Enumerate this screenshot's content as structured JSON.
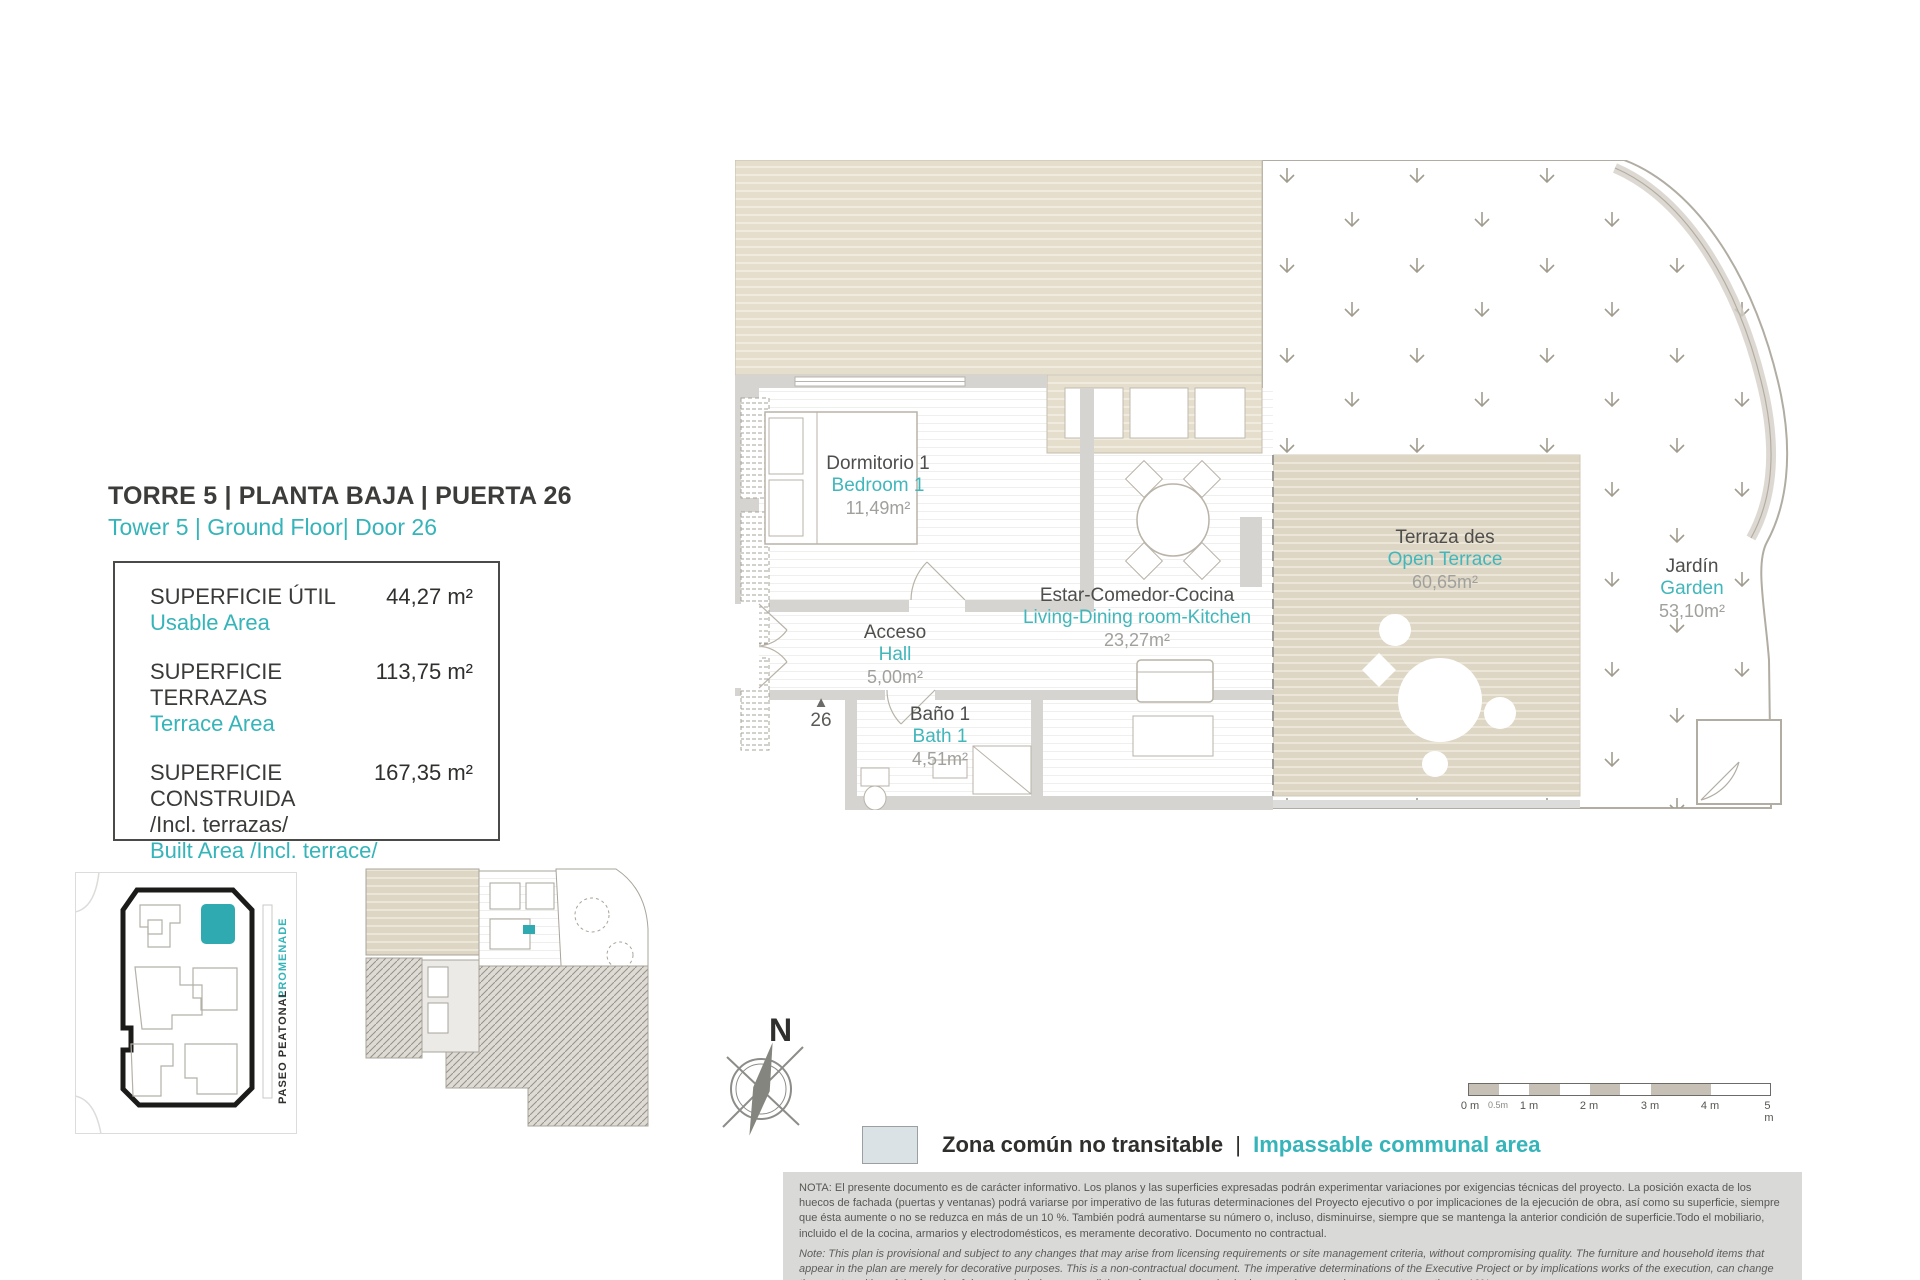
{
  "colors": {
    "accent": "#35b4b9",
    "dark_text": "#3a3a38",
    "beige_deck": "#ded6c4",
    "wall_gray": "#d5d4d0",
    "legend_swatch": "#dbe2e6",
    "note_bg": "#d9d9d8"
  },
  "header": {
    "title": "TORRE 5 | PLANTA BAJA | PUERTA 26",
    "subtitle": "Tower 5 | Ground Floor| Door 26"
  },
  "areas": {
    "rows": [
      {
        "label": "SUPERFICIE ÚTIL",
        "sublabel": "",
        "label_en": "Usable Area",
        "value": "44,27 m²"
      },
      {
        "label": "SUPERFICIE TERRAZAS",
        "sublabel": "",
        "label_en": "Terrace Area",
        "value": "113,75 m²"
      },
      {
        "label": "SUPERFICIE CONSTRUIDA",
        "sublabel": "/Incl. terrazas/",
        "label_en": "Built Area /Incl. terrace/",
        "value": "167,35 m²"
      }
    ]
  },
  "site_plan": {
    "promenade": "PROMENADE",
    "paseo": "PASEO PEATONAL"
  },
  "compass": {
    "north": "N"
  },
  "plan": {
    "entrance_marker": "▲",
    "entrance_number": "26",
    "rooms": {
      "bedroom": {
        "es": "Dormitorio 1",
        "en": "Bedroom 1",
        "area": "11,49m²"
      },
      "living": {
        "es": "Estar-Comedor-Cocina",
        "en": "Living-Dining room-Kitchen",
        "area": "23,27m²"
      },
      "hall": {
        "es": "Acceso",
        "en": "Hall",
        "area": "5,00m²"
      },
      "bath": {
        "es": "Baño 1",
        "en": "Bath 1",
        "area": "4,51m²"
      },
      "terrace": {
        "es": "Terraza des",
        "en": "Open Terrace",
        "area": "60,65m²"
      },
      "garden": {
        "es": "Jardín",
        "en": "Garden",
        "area": "53,10m²"
      }
    }
  },
  "legend": {
    "es": "Zona común no transitable",
    "sep": "|",
    "en": "Impassable communal area"
  },
  "scale_bar": {
    "labels": [
      "0 m",
      "0.5m",
      "1 m",
      "2 m",
      "3 m",
      "4 m",
      "5 m"
    ]
  },
  "notes": {
    "es": "NOTA:  El presente documento es de carácter informativo. Los planos y las superficies expresadas podrán experimentar variaciones por exigencias técnicas del proyecto. La posición exacta de los huecos de fachada (puertas y ventanas) podrá variarse por imperativo de las futuras determinaciones del Proyecto ejecutivo o por implicaciones de la ejecución de obra, así como su superficie, siempre que ésta aumente o no se reduzca en más de un 10 %. También podrá aumentarse su número o, incluso, disminuirse, siempre que se mantenga la anterior condición de superficie.Todo el mobiliario, incluido el de la cocina, armarios y electrodomésticos, es meramente decorativo. Documento no contractual.",
    "en": "Note: This plan is provisional and subject to any changes that may arise from licensing requirements or site management criteria, without compromising quality. The furniture and household items that appear in the plan are merely for decorative purposes. This is a non-contractual document. The imperative determinations of the Executive Project or by implications works of the execution, can change the exact position of the facade of doors and windows, as well the surface area may also be increased or even decrease not more than a 10%.",
    "version": "V.1_ENE-22"
  }
}
